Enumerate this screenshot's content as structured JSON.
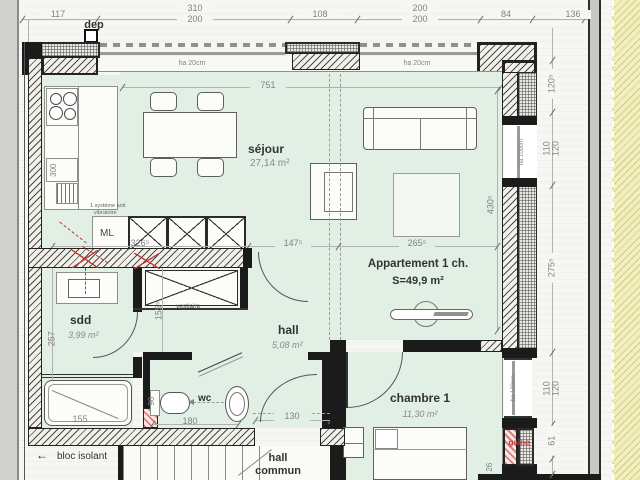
{
  "plan": {
    "dep": "dep",
    "title_dims_top": [
      {
        "a": "117"
      },
      {
        "a": "310",
        "b": "200"
      },
      {
        "a": "108"
      },
      {
        "a": "200",
        "b": "200"
      },
      {
        "a": "84"
      },
      {
        "a": "136"
      }
    ],
    "windows": {
      "top_a": "ha 20cm",
      "top_b": "ha 20cm",
      "right_living": "ha 100cm",
      "right_bedroom": "ha 120cm"
    },
    "rooms": {
      "sejour": {
        "label": "séjour",
        "area": "27,14 m²"
      },
      "apartment": {
        "label": "Appartement 1 ch.",
        "surface": "S=49,9 m²"
      },
      "sdd": {
        "label": "sdd",
        "area": "3,99 m²"
      },
      "vestiaire": {
        "label": "vestiaire"
      },
      "hall": {
        "label": "hall",
        "area": "5,08 m²"
      },
      "wc": {
        "label": "wc"
      },
      "chambre": {
        "label": "chambre 1",
        "area": "11,30 m²"
      },
      "hall_commun": {
        "line1": "hall",
        "line2": "commun"
      }
    },
    "annotations": {
      "ml": "ML",
      "anti_vib_line1": "1 système anti",
      "anti_vib_line2": "vibratoire",
      "bloc_isolant": "bloc isolant",
      "bloc_isolant_arrow": "←",
      "gaine": "gaine"
    },
    "dims": {
      "sejour_width": "751",
      "sejour_height": "430⁵",
      "counter": "326⁵",
      "opening": "147⁵",
      "living_right": "265⁵",
      "vestiaire_h": "155⁵",
      "sdd_h": "257",
      "fridge": "300",
      "tub": "155",
      "wc_w": "180",
      "wc_h": "90",
      "hall_door": "130",
      "right_chain": [
        {
          "a": "120⁵"
        },
        {
          "a": "110",
          "b": "120"
        },
        {
          "a": "275⁵"
        },
        {
          "a": "110",
          "b": "120"
        },
        {
          "a": "61"
        },
        {
          "a": "26"
        }
      ]
    },
    "colors": {
      "room_fill": "#e1efe5",
      "neighbor_fill": "#f3eebd",
      "accent_red": "#c23a35"
    }
  }
}
